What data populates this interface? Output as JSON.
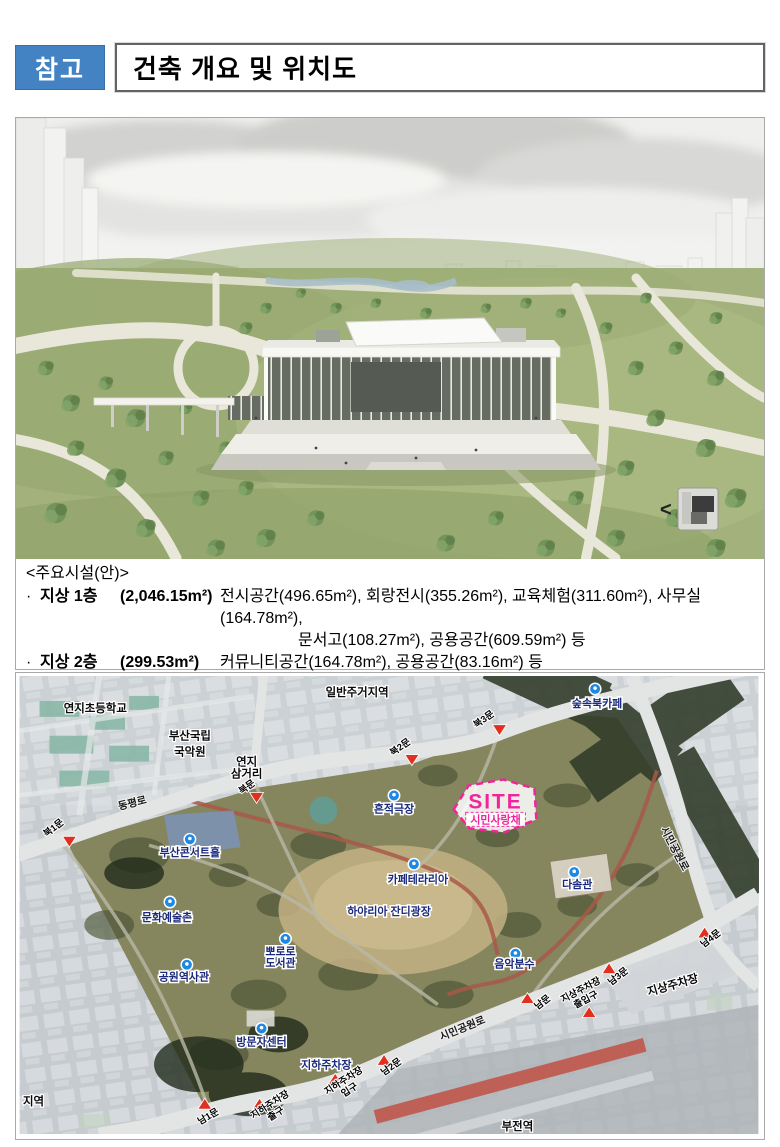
{
  "page": {
    "badge": "참고",
    "title": "건축 개요 및 위치도"
  },
  "facilities": {
    "heading": "<주요시설(안)>",
    "rows": [
      {
        "bullet": "·",
        "name": "지상 1층",
        "area": "(2,046.15m²)",
        "desc": "전시공간(496.65m²), 회랑전시(355.26m²), 교육체험(311.60m²), 사무실(164.78m²),",
        "cont": "문서고(108.27m²), 공용공간(609.59m²) 등"
      },
      {
        "bullet": "·",
        "name": "지상 2층",
        "area": "(299.53m²)",
        "desc": "커뮤니티공간(164.78m²), 공용공간(83.16m²) 등",
        "cont": ""
      },
      {
        "bullet": "·",
        "name": "야외",
        "area": "(680.00m²)",
        "desc": "외부 추모공간",
        "cont": ""
      }
    ]
  },
  "render": {
    "compass_arrow": "<"
  },
  "map": {
    "site": {
      "title": "SITE",
      "name": "시민사랑채"
    },
    "places": {
      "school": "연지초등학교",
      "gugak_line1": "부산국립",
      "gugak_line2": "국악원",
      "residential": "일반주거지역",
      "yeonji_line1": "연지",
      "yeonji_line2": "삼거리",
      "road_north": "동평로",
      "road_east": "시민공원로",
      "road_south": "시민공원로",
      "district_partial": "지역",
      "bujeon_station": "부전역",
      "ground_parking": "지상주차장",
      "underground_parking": "지하주차장"
    },
    "facilities": {
      "book_cafe": "숲속북카페",
      "trace_theater": "흔적극장",
      "concert_hall": "부산콘서트홀",
      "art_village": "문화예술촌",
      "cafeteria": "카페테라리아",
      "dasom_hall": "다솜관",
      "lawn_plaza": "하야리아 잔디광장",
      "pororo_line1": "뽀로로",
      "pororo_line2": "도서관",
      "history_hall": "공원역사관",
      "music_fountain": "음악분수",
      "visitor_center": "방문자센터"
    },
    "gates": {
      "north1": "북1문",
      "north": "북문",
      "north2": "북2문",
      "north3": "북3문",
      "south1": "남1문",
      "south2": "남2문",
      "south": "남문",
      "south3": "남3문",
      "south4": "남4문",
      "ug_exit_line1": "지하주차장",
      "ug_exit_line2": "출구",
      "ug_entrance_line1": "지하주차장",
      "ug_entrance_line2": "입구",
      "g_gate_line1": "지상주차장",
      "g_gate_line2": "출입구"
    }
  },
  "colors": {
    "badge_blue": "#4383c4",
    "site_pink": "#f2239b",
    "marker_blue": "#1e88e5",
    "arrow_red": "#e03020",
    "facility_label_navy": "#1b2a7b"
  }
}
